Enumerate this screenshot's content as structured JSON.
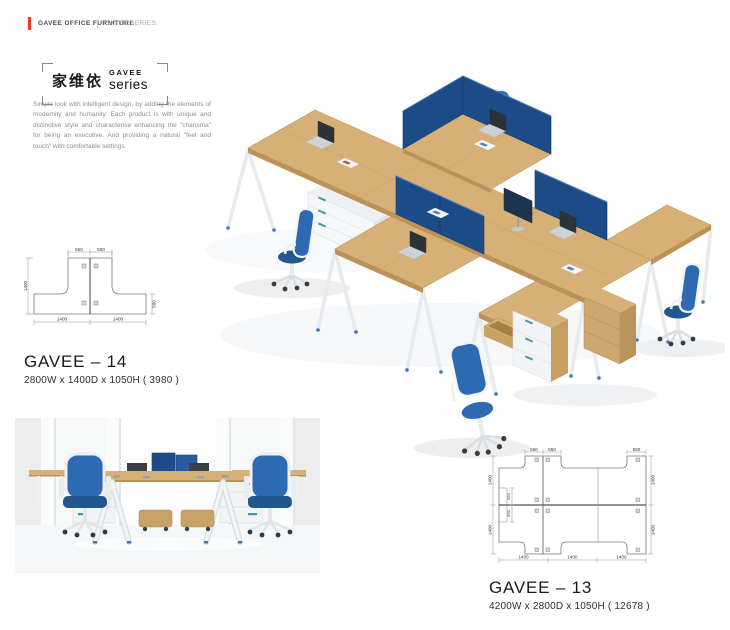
{
  "header": {
    "brand": "GAVEE OFFICE FURNITURE",
    "series": "GAVEE SERIES"
  },
  "logo": {
    "chinese": "家维依",
    "latin_top": "GAVEE",
    "latin_bottom": "series"
  },
  "intro": "Simple look with intelligent design, by adding the elements of modernity and humanity. Each product is with unique and distinctive style and characterise enhancing the \"charisma\" for being an executive. And providing a natural \"feel and touch\" with comfortable settings.",
  "products": {
    "gavee14": {
      "name": "GAVEE – 14",
      "dimensions": "2800W x 1400D x 1050H ( 3980 )",
      "plan": {
        "top_widths": [
          "550",
          "550"
        ],
        "left_depth": "1400",
        "right_depth": "500",
        "bottom_widths": [
          "1400",
          "1400"
        ]
      }
    },
    "gavee13": {
      "name": "GAVEE – 13",
      "dimensions": "4200W x 2800D x 1050H ( 12678 )",
      "plan": {
        "top_widths": [
          "550",
          "550",
          "550"
        ],
        "left_depths": [
          "1400",
          "1400"
        ],
        "side_offsets": [
          "550",
          "550"
        ],
        "right_depths": [
          "1400",
          "1400"
        ],
        "bottom_widths": [
          "1400",
          "1400",
          "1400"
        ]
      }
    }
  },
  "scene": {
    "accent_red": "#e8392e",
    "wood": "#d6b076",
    "wood_edge": "#bb9257",
    "screen": "#1d4b87",
    "screen_edge": "#123a6d",
    "chair": "#2e6ab1",
    "chair_seat": "#21568f",
    "metal_white": "#f0f3f5",
    "drawer_pull": "#4792a8"
  }
}
